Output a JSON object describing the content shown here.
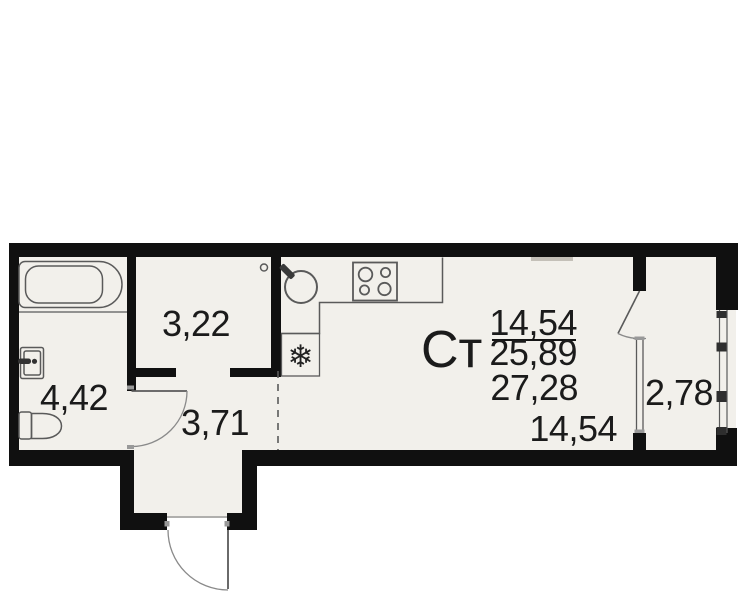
{
  "plan": {
    "unit_type_label": "Ст",
    "area_summary": {
      "living_area": "14,54",
      "area_without_balcony": "25,89",
      "total_area": "27,28"
    },
    "rooms": [
      {
        "name": "bathroom",
        "area": "4,42"
      },
      {
        "name": "closet",
        "area": "3,22"
      },
      {
        "name": "hallway",
        "area": "3,71"
      },
      {
        "name": "living-room",
        "area": "14,54"
      },
      {
        "name": "balcony",
        "area": "2,78"
      }
    ],
    "icons": {
      "freezer": "❄"
    },
    "colors": {
      "wall": "#101010",
      "floor": "#f2f0eb",
      "outline_gray": "#5a5a5a",
      "text": "#1b1b1b",
      "background": "#ffffff"
    }
  }
}
